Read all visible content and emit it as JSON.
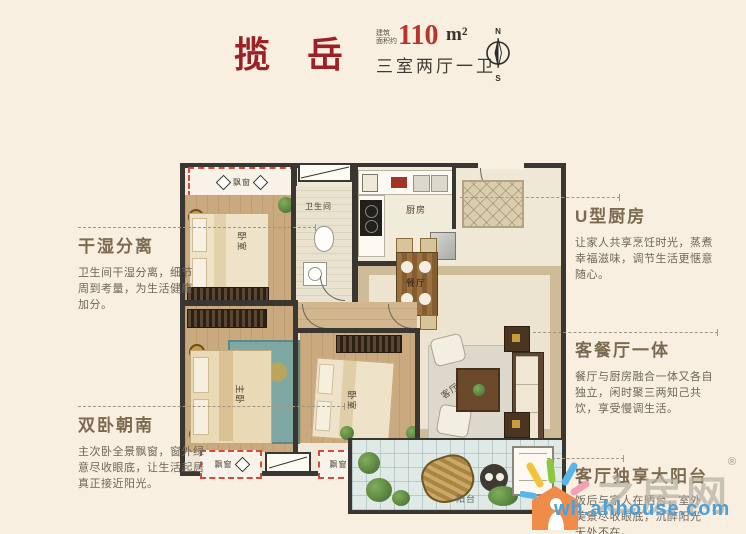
{
  "header": {
    "title": "揽 岳",
    "area_prefix1": "建筑",
    "area_prefix2": "面积约",
    "area_value": "110",
    "area_unit": "m²",
    "layout_text": "三室两厅一卫",
    "compass_n": "N",
    "compass_s": "S"
  },
  "annotations": {
    "left": [
      {
        "title": "干湿分离",
        "body": "卫生间干湿分离，细节周到考量，为生活健康加分。"
      },
      {
        "title": "双卧朝南",
        "body": "主次卧全景飘窗，窗外绿意尽收眼底，让生活起居真正接近阳光。"
      }
    ],
    "right": [
      {
        "title": "U型厨房",
        "body": "让家人共享烹饪时光，蒸煮幸福滋味，调节生活更惬意随心。"
      },
      {
        "title": "客餐厅一体",
        "body": "餐厅与厨房融合一体又各自独立，闲时聚三两知己共饮，享受慢调生活。"
      },
      {
        "title": "客厅独享大阳台",
        "body": "饭后与家人在晒台，室外美景尽收眼底，沉醉阳光无处不在。"
      }
    ]
  },
  "plan": {
    "labels": {
      "bay_top": "飘窗",
      "bedroom_top": "卧室",
      "bathroom": "卫生间",
      "kitchen": "厨房",
      "dining": "餐厅",
      "living": "客厅",
      "master": "主卧",
      "bedroom_mid": "卧室",
      "bay_left": "飘窗",
      "bay_mid": "飘窗",
      "balcony": "阳台"
    }
  },
  "watermark": {
    "brand": "之房网",
    "reg": "®",
    "url": "wh.ahhouse.com"
  },
  "colors": {
    "background": "#f8efe0",
    "title_red": "#9b2126",
    "area_red": "#b8352b",
    "annotation_title": "#7b6a50",
    "bay_window_red": "#d24b3e",
    "wall_dark": "#3a3631",
    "url_blue": "#49a0db"
  }
}
